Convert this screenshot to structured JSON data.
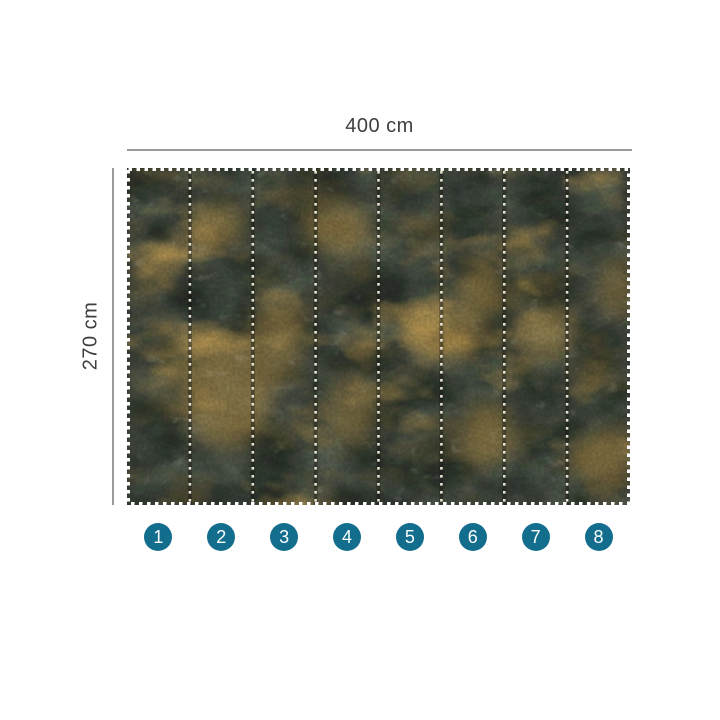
{
  "product_diagram": {
    "title": "wallpaper-mural-panel-layout",
    "width_label": "400 cm",
    "height_label": "270 cm",
    "panel_count": 8,
    "panel_numbers": [
      "1",
      "2",
      "3",
      "4",
      "5",
      "6",
      "7",
      "8"
    ],
    "colors": {
      "page_background": "#ffffff",
      "badge_background": "#136d8d",
      "badge_text": "#ffffff",
      "dimension_text": "#3f3f3f",
      "dimension_line": "#9b9b9b",
      "mural_base_green": "#434b43",
      "mural_dark_mottle": "#141a14",
      "mural_light_mottle": "#8f977f",
      "mural_gold": "#c9a255",
      "mural_gold_dark": "#8a6f3a",
      "divider_dots": "#f3eedd"
    }
  }
}
